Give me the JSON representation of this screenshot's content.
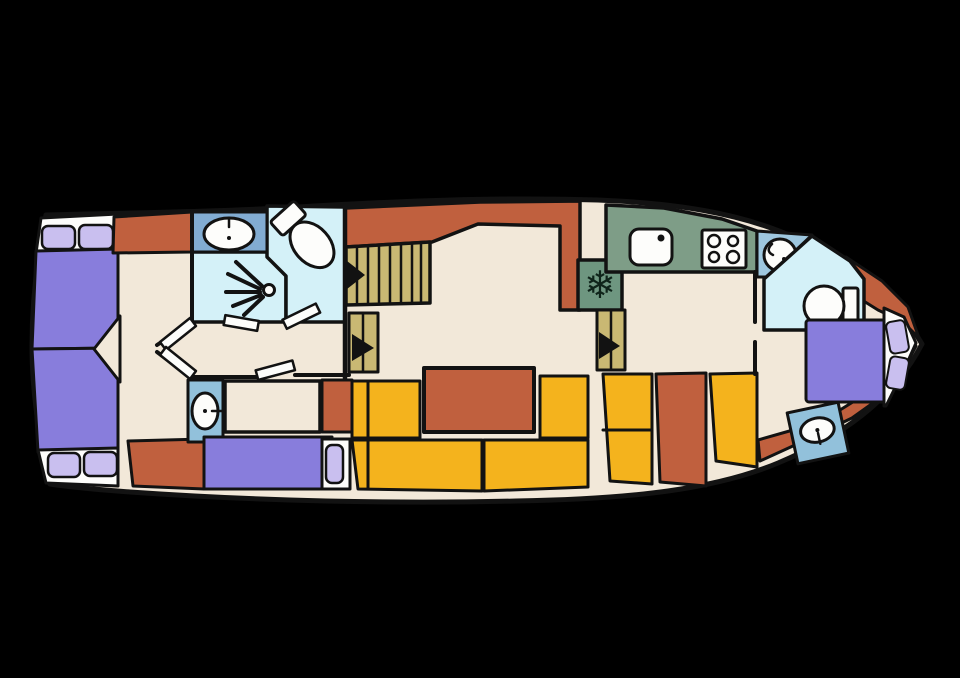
{
  "palette": {
    "background": "#000000",
    "line": "#121212",
    "deck": "#F2E8D9",
    "trim_white": "#FDFDFB",
    "rust": "#C0603E",
    "bed_purple": "#887DDC",
    "pillow_lavender": "#C9BFEF",
    "seat_yellow": "#F4B31D",
    "stair_tan": "#C9B873",
    "counter_green": "#7E9D87",
    "fridge_green": "#6E9680",
    "wet_blue": "#82ACD2",
    "basin_blue": "#92C1DB",
    "aft_basin_blue": "#9EC7DF",
    "room_cyan": "#D4F1F8"
  },
  "icons": {
    "snowflake_glyph": "❄"
  },
  "plan": {
    "type": "boat-deck-floor-plan",
    "rooms": [
      {
        "id": "forward-cabin",
        "fixtures": [
          "double-bed-forward-upper",
          "double-bed-forward-lower",
          "pillows",
          "double-door"
        ]
      },
      {
        "id": "forward-bathroom",
        "fixtures": [
          "washbasin",
          "toilet",
          "shower"
        ]
      },
      {
        "id": "mid-cabin",
        "fixtures": [
          "washbasin",
          "single-bed",
          "wardrobe"
        ]
      },
      {
        "id": "salon",
        "fixtures": [
          "companionway-stairs",
          "step-down",
          "dinette-table",
          "bench-seating"
        ]
      },
      {
        "id": "galley",
        "fixtures": [
          "sink",
          "stove-4-burner",
          "fridge-freezer",
          "step-down"
        ]
      },
      {
        "id": "aft-bathroom",
        "fixtures": [
          "washbasin",
          "toilet"
        ]
      },
      {
        "id": "aft-cabin",
        "fixtures": [
          "double-bed",
          "pillows",
          "washbasin"
        ]
      }
    ]
  }
}
